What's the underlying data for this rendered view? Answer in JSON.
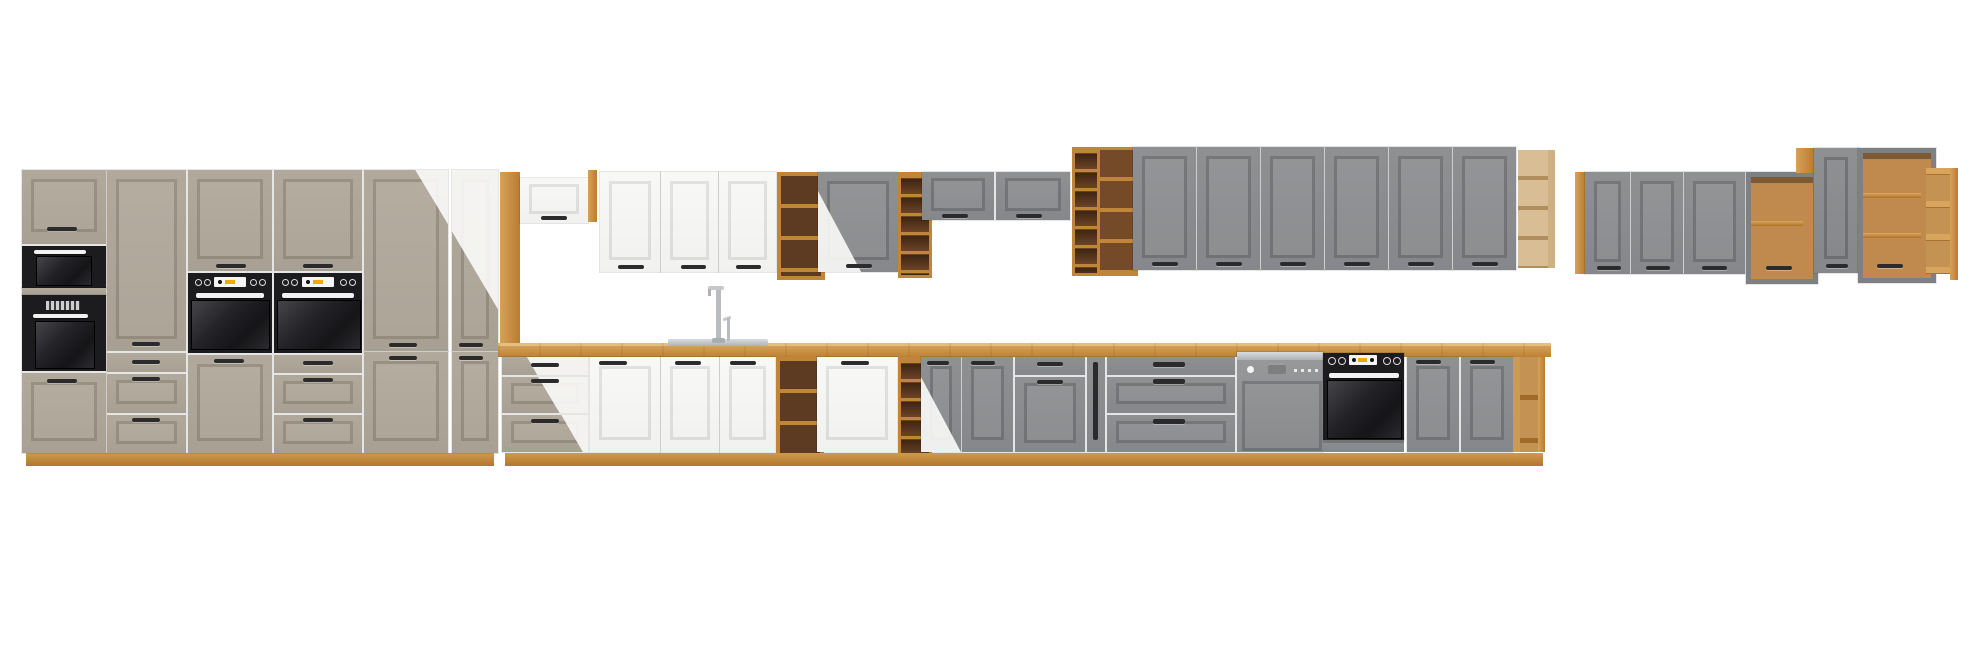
{
  "scene": {
    "description": "3D render of a modular kitchen furniture lineup on a white background, no visible text",
    "sections": [
      {
        "name": "tall-unit-run-clay",
        "color_key": "taupe",
        "units": 6,
        "appliances": [
          "built-in-microwave",
          "built-in-oven",
          "built-in-oven",
          "built-in-oven"
        ]
      },
      {
        "name": "wall-units-white",
        "color_key": "white_door",
        "units": 4
      },
      {
        "name": "wall-units-grey",
        "color_key": "grey",
        "units": 13
      },
      {
        "name": "base-run",
        "units": 17,
        "appliances": [
          "sink-with-tap",
          "dishwasher",
          "built-in-oven"
        ]
      },
      {
        "name": "open-shelf-units-oak",
        "color_key": "oak",
        "units": 8
      }
    ],
    "transitions": "two diagonal color sweeps: clay-to-white over the tall run, white-to-grey near the middle"
  },
  "colors": {
    "taupe": "#aca496",
    "white_door": "#f6f6f4",
    "grey": "#898b8d",
    "oak": "#c98f42",
    "oak_pale": "#d9bd94",
    "interior_dark": "#5d3a22",
    "appliance_black": "#1c1c1e",
    "handle": "#2b2b2e",
    "steel": "#b9bcbf",
    "accent_orange": "#f5a800",
    "background": "#ffffff"
  }
}
